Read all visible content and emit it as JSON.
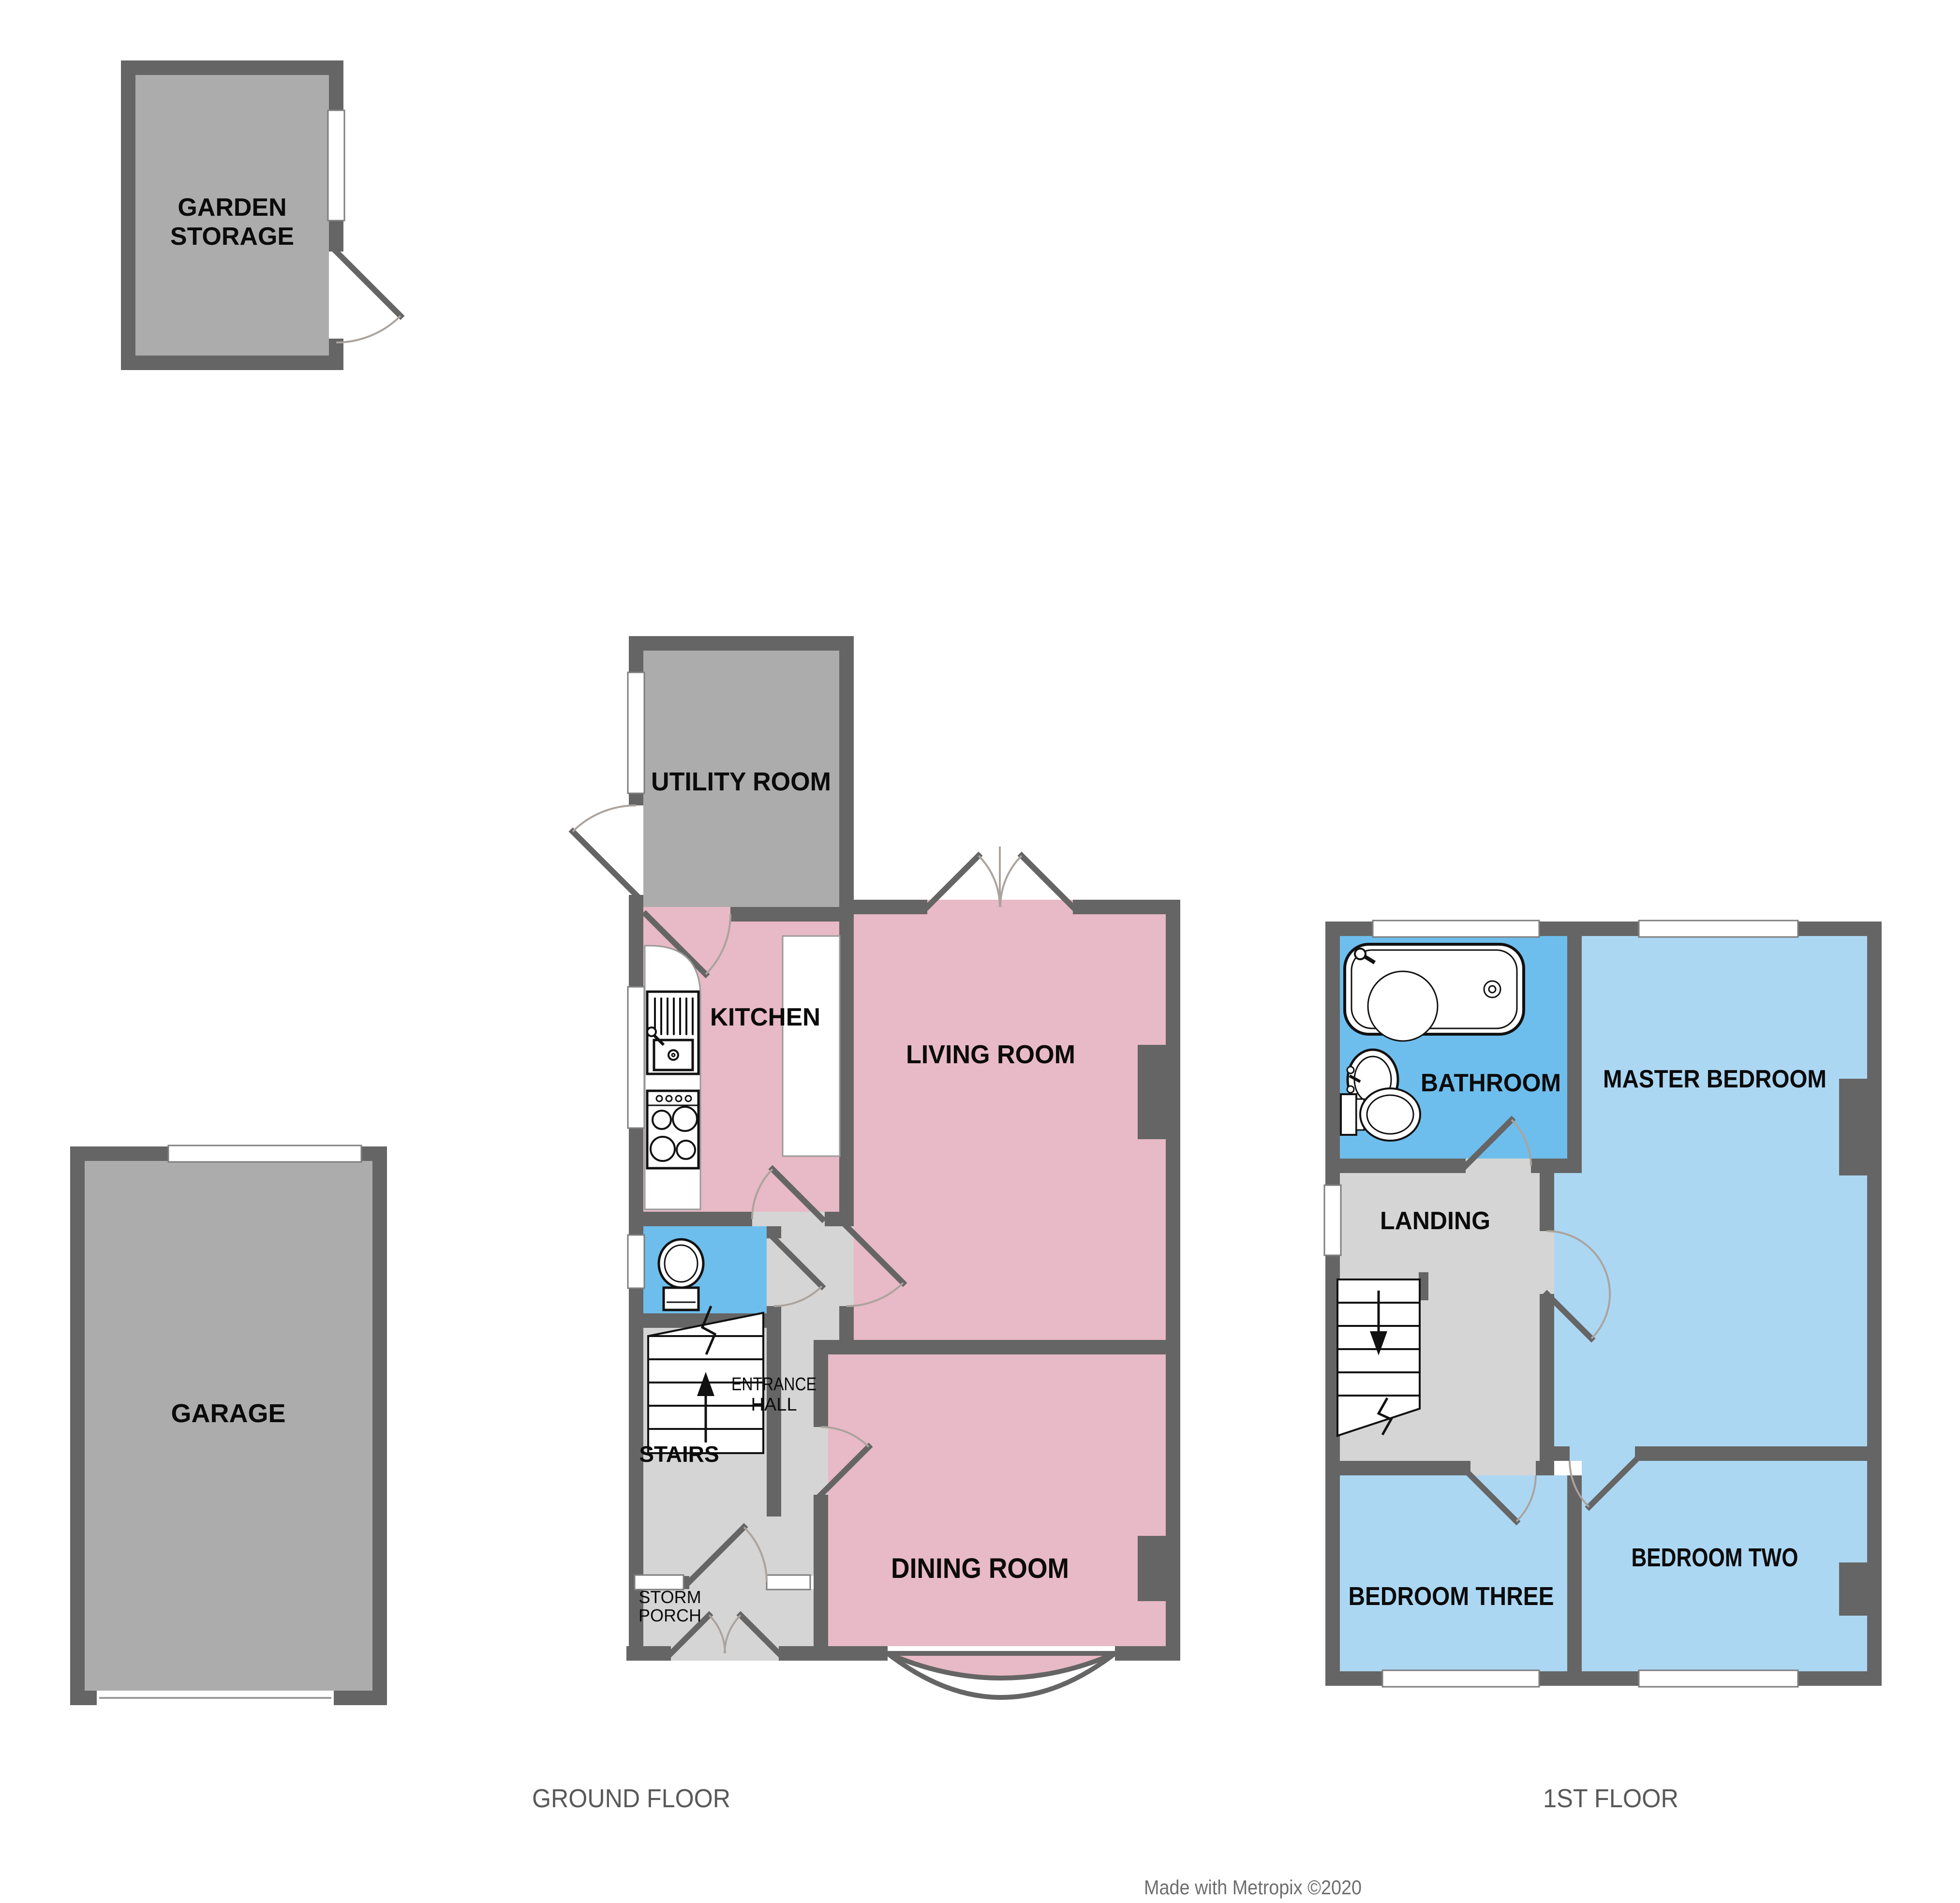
{
  "document": {
    "type": "floorplan",
    "credit": "Made with Metropix ©2020"
  },
  "outbuildings": {
    "garden_storage_line1": "GARDEN",
    "garden_storage_line2": "STORAGE",
    "garage": "GARAGE"
  },
  "floors": [
    {
      "label": "GROUND FLOOR",
      "rooms": {
        "utility": "UTILITY ROOM",
        "kitchen": "KITCHEN",
        "living": "LIVING ROOM",
        "dining": "DINING ROOM",
        "entrance_hall_line1": "ENTRANCE",
        "entrance_hall_line2": "HALL",
        "stairs": "STAIRS",
        "storm_porch_line1": "STORM",
        "storm_porch_line2": "PORCH"
      }
    },
    {
      "label": "1ST FLOOR",
      "rooms": {
        "bathroom": "BATHROOM",
        "master_bedroom": "MASTER BEDROOM",
        "landing": "LANDING",
        "bedroom_three": "BEDROOM THREE",
        "bedroom_two": "BEDROOM TWO"
      }
    }
  ],
  "colors": {
    "wall": "#656565",
    "outbuilding_fill": "#acacac",
    "reception_fill": "#e8b9c6",
    "bedroom_fill": "#acd7f3",
    "bathroom_fill": "#6dbeec",
    "hall_fill": "#d5d5d5",
    "window": "#ffffff",
    "floor_label": "#595959",
    "credit": "#6e6e6e"
  }
}
